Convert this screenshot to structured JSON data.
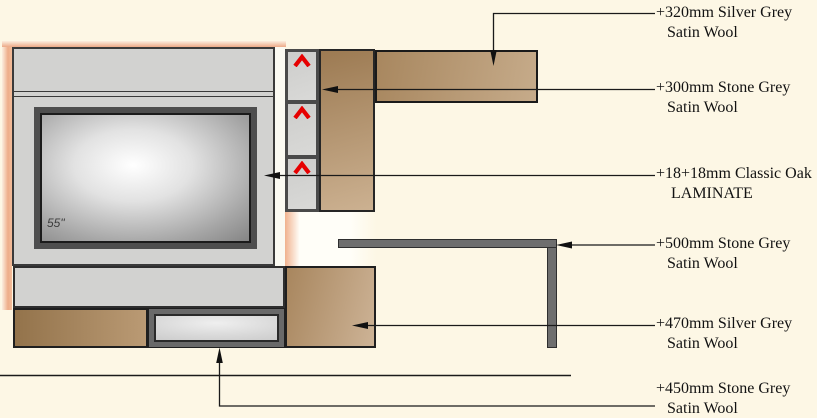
{
  "drawing": {
    "tv_size_label": "55\"",
    "icons": {
      "shelf_clip": "chevron-up"
    }
  },
  "annotations": [
    {
      "line1": "+320mm Silver Grey",
      "line2": "Satin Wool"
    },
    {
      "line1": "+300mm Stone Grey",
      "line2": "Satin Wool"
    },
    {
      "line1": "+18+18mm Classic Oak",
      "line2": "LAMINATE"
    },
    {
      "line1": "+500mm Stone Grey",
      "line2": "Satin Wool"
    },
    {
      "line1": "+470mm Silver Grey",
      "line2": "Satin Wool"
    },
    {
      "line1": "+450mm Stone Grey",
      "line2": "Satin Wool"
    }
  ],
  "colors": {
    "background": "#FDF7E5",
    "panel_grey": "#D2D2D0",
    "wood_dark": "#9C7A52",
    "wood_light": "#CDB396",
    "clip_red": "#E60000",
    "table_grey": "#6E6E6E",
    "glow_peach": "#EEAD89",
    "line_black": "#1A1A1A"
  }
}
